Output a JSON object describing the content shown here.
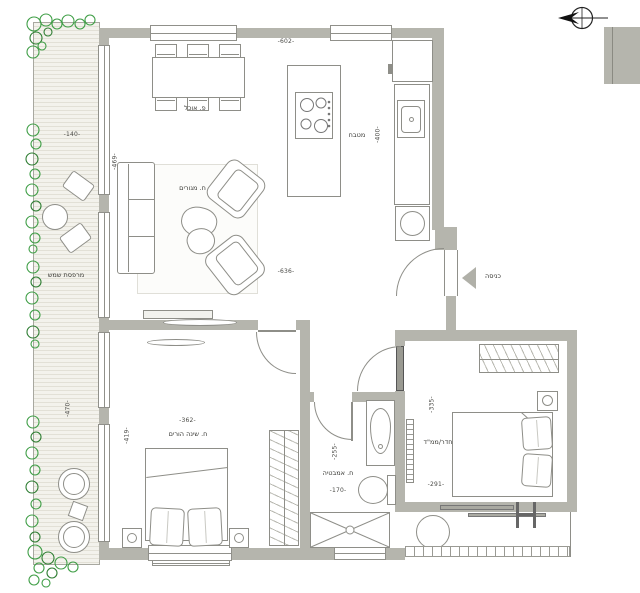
{
  "title": "apartment-floor-plan",
  "colors": {
    "wall": "#b5b5ad",
    "furniture_outline": "#8e8e88",
    "deck": "#f3f2ec",
    "deck_stripe": "#e2e0d6",
    "plant_green": "#3f9e46",
    "text": "#3a3a36"
  },
  "rooms": {
    "balcony": {
      "name": "מרפסת שמש",
      "width": "-140-",
      "height": "-470-"
    },
    "living_room": {
      "name": "ח. מגורים",
      "top_width": "-602-",
      "width": "-636-",
      "height": "-469-"
    },
    "dining": {
      "name": "פ. אוכל"
    },
    "kitchen": {
      "name": "מטבח",
      "height": "-400-"
    },
    "entrance": {
      "name": "כניסה"
    },
    "master_bedroom": {
      "name": "ח. שינה הורים",
      "width": "-362-",
      "height": "-419-"
    },
    "bathroom": {
      "name": "ח. אמבטיה",
      "width": "-170-",
      "height": "-255-"
    },
    "safe_room": {
      "name": "חדר/ממ\"ד",
      "width": "-291-",
      "height": "-335-"
    }
  }
}
